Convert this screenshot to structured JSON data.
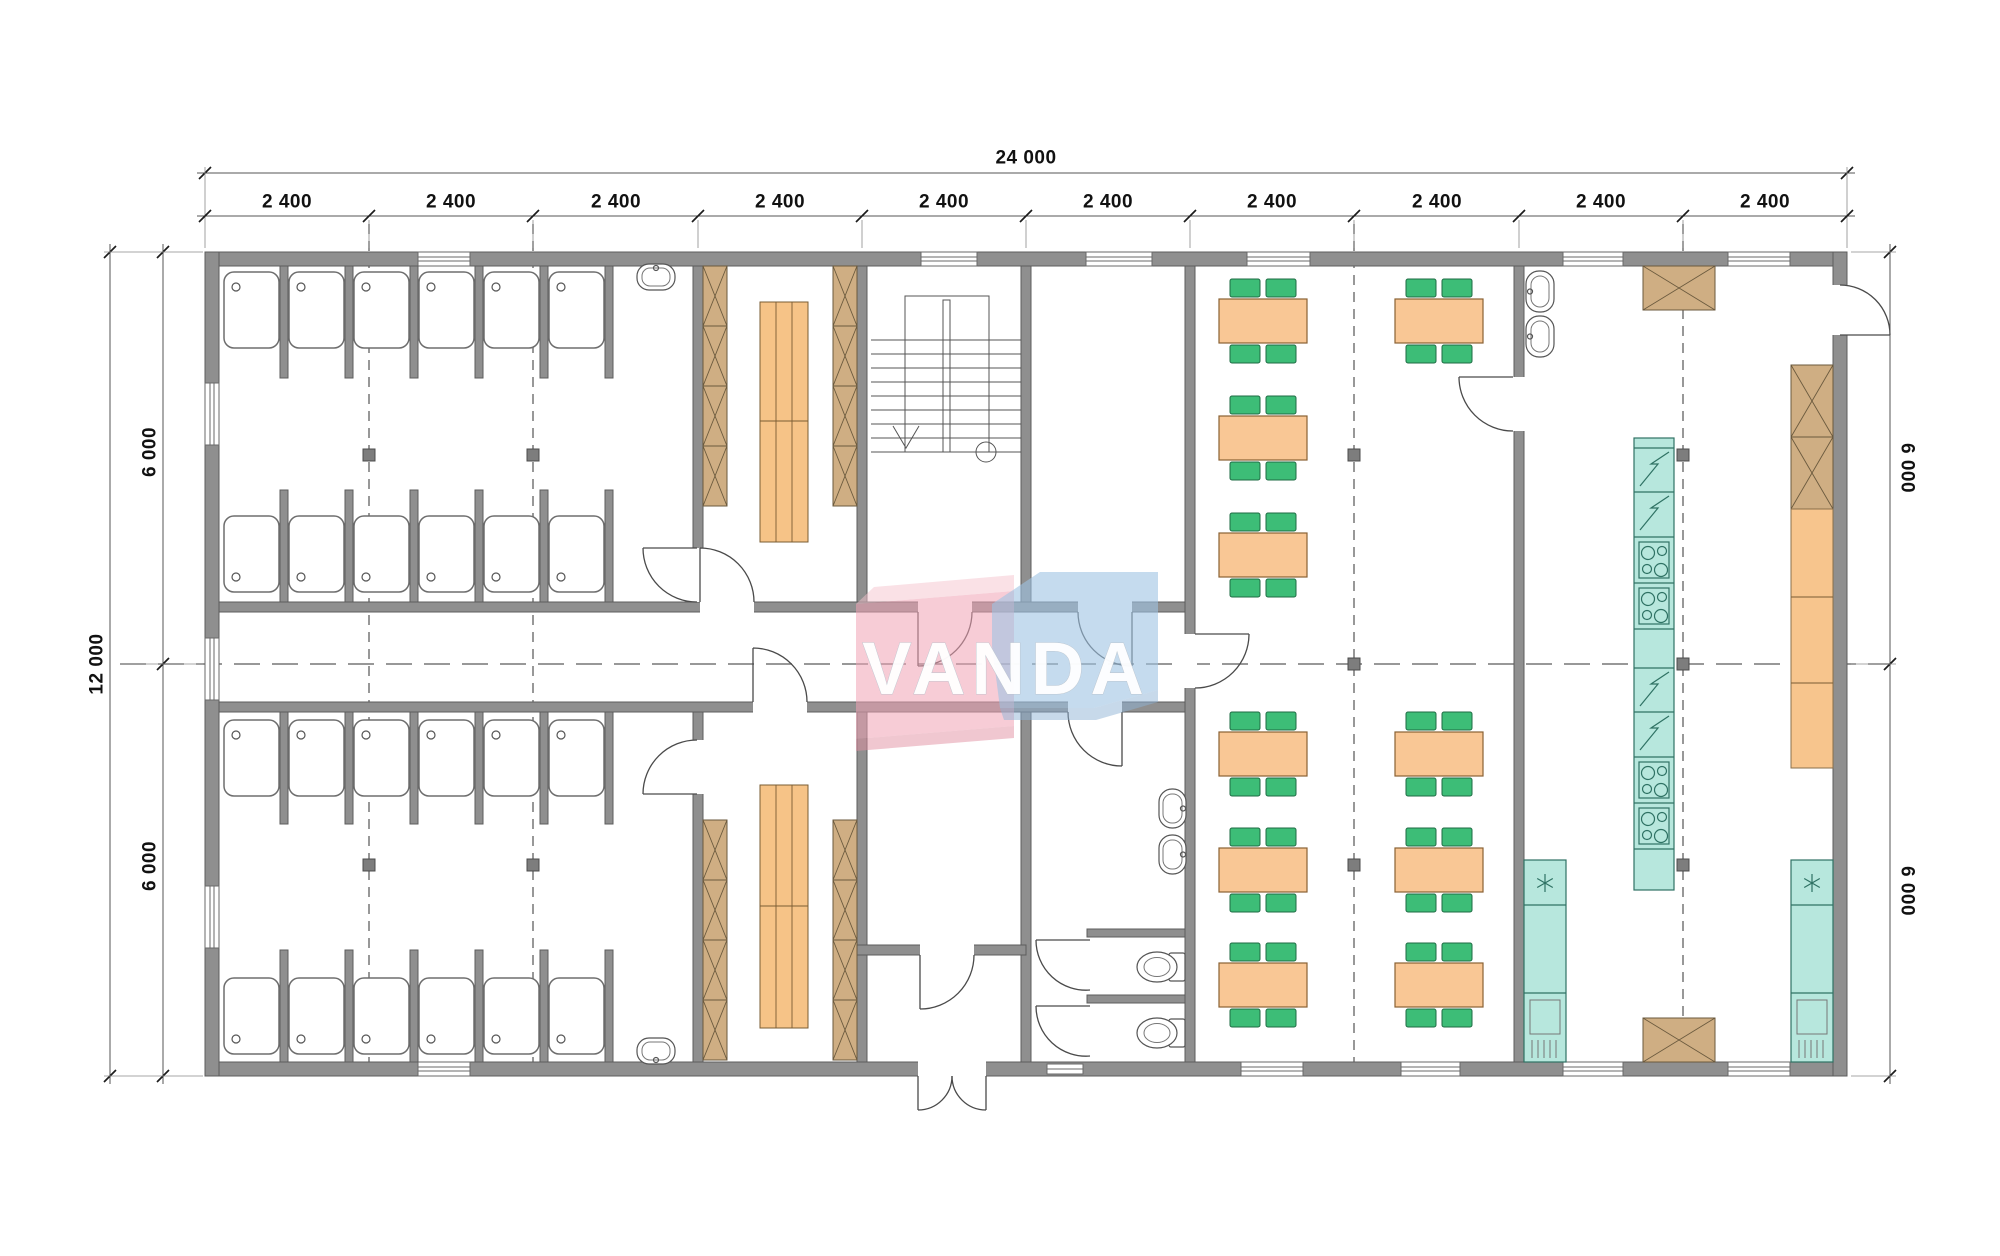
{
  "watermark": {
    "text": "VANDA",
    "pink_color": "#f0a3b4",
    "blue_color": "#9fc3e3"
  },
  "dimensions": {
    "top_total": "24 000",
    "top_segments": [
      "2 400",
      "2 400",
      "2 400",
      "2 400",
      "2 400",
      "2 400",
      "2 400",
      "2 400",
      "2 400",
      "2 400"
    ],
    "left_total": "12 000",
    "left_upper": "6 000",
    "left_lower": "6 000",
    "right_upper": "6 000",
    "right_lower": "6 000"
  },
  "colors": {
    "wall": "#8f8f8f",
    "wood_locker": "#cfae83",
    "bench": "#f6c387",
    "table": "#f9c795",
    "chair": "#3dbd77",
    "appliance_teal": "#b7e7dd",
    "counter_orange": "#f7c58d",
    "centerline": "#767676",
    "dimension_line": "#555555"
  },
  "plan": {
    "grid": {
      "bays_x": 10,
      "bay_mm": 2400,
      "total_mm_x": 24000,
      "halves_y_mm": [
        6000,
        6000
      ],
      "total_mm_y": 12000
    },
    "rooms": [
      {
        "name": "shower-room-north",
        "shower_stalls": 12,
        "washbasins": 1
      },
      {
        "name": "shower-room-south",
        "shower_stalls": 12,
        "washbasins": 1
      },
      {
        "name": "changing-room-north",
        "locker_units": 8,
        "benches": 1
      },
      {
        "name": "changing-room-south",
        "locker_units": 8,
        "benches": 1
      },
      {
        "name": "stair-hall",
        "stair_flights": 1
      },
      {
        "name": "corridor"
      },
      {
        "name": "entrance-vestibule",
        "exterior_door_leaves": 2
      },
      {
        "name": "washroom",
        "washbasins": 2,
        "wc_cubicles": 2
      },
      {
        "name": "dining-room",
        "tables_north": 4,
        "tables_south": 6,
        "chairs_per_table": 4
      },
      {
        "name": "kitchen",
        "sinks": 2,
        "stove_modules": 4,
        "electric_modules": 4,
        "refrigerators": 2,
        "wood_counters": 4,
        "orange_cabinets": 3
      }
    ]
  }
}
